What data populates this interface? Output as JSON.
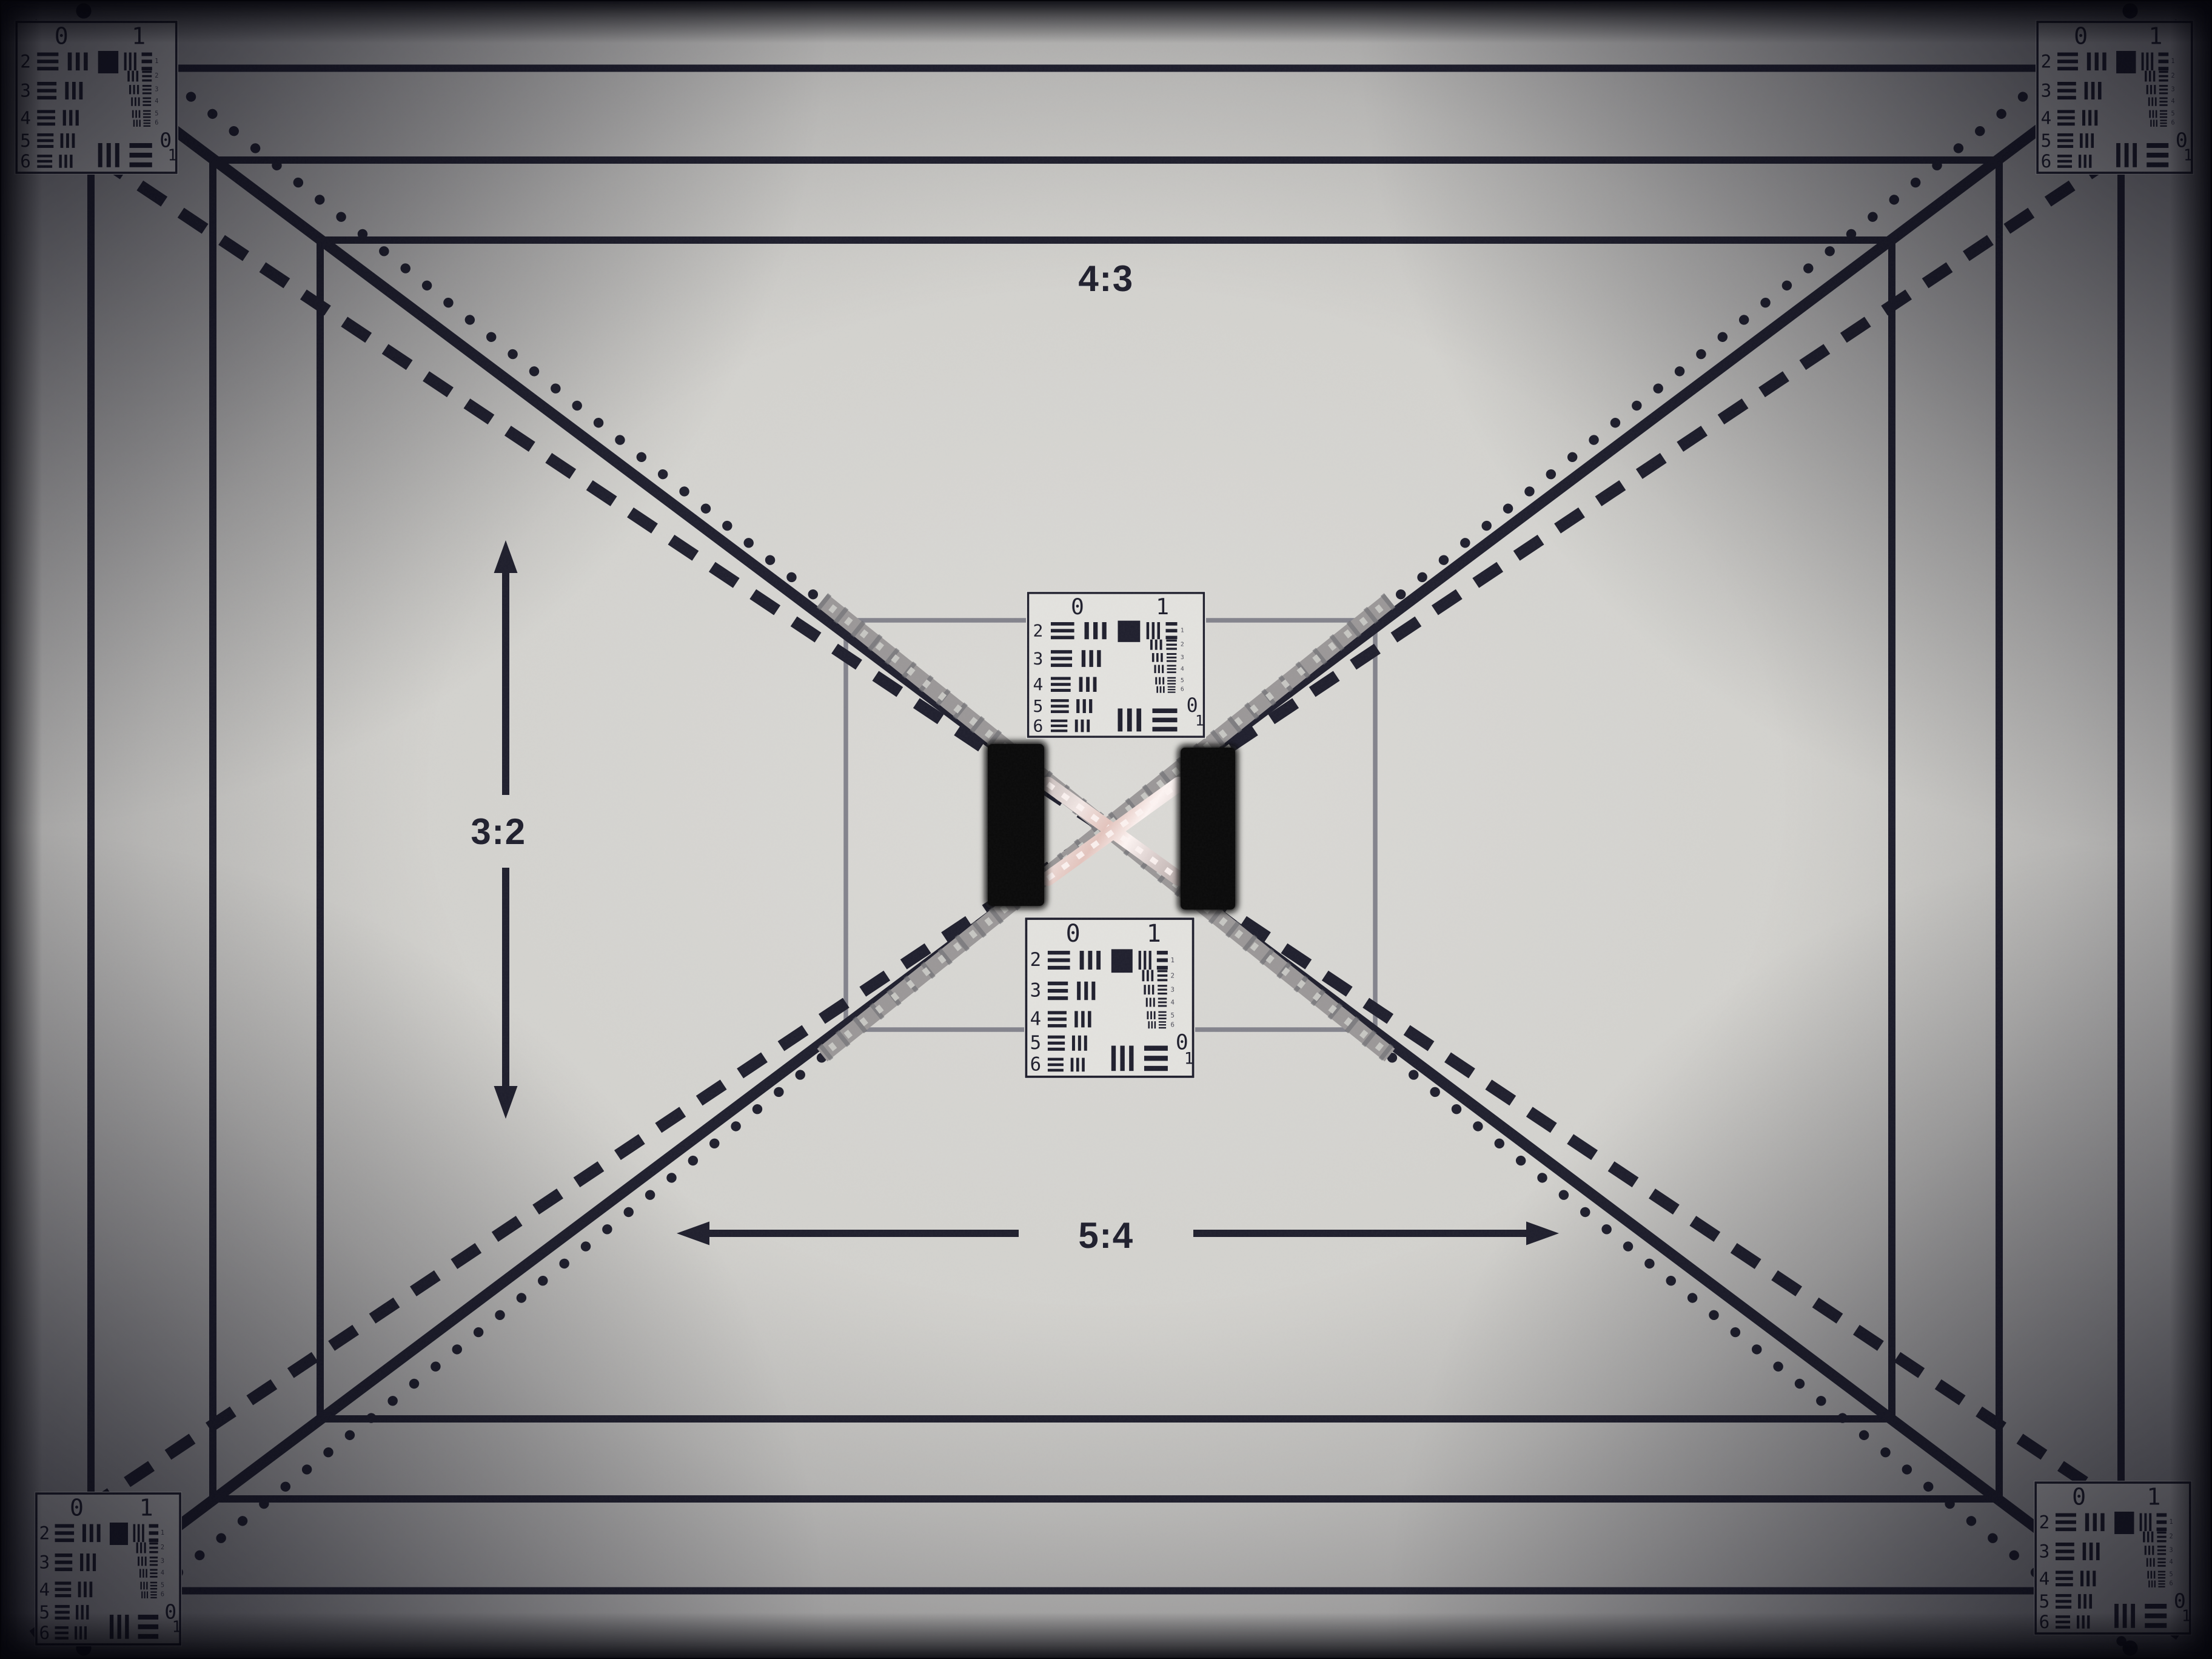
{
  "scene": {
    "description": "Photograph of a printed camera lens test chart with aspect-ratio frames, diagonal reference lines, six USAF-1951 resolution targets, two black velcro pads and a metallic reflective X at the center"
  },
  "labels": {
    "aspect_top": "4:3",
    "aspect_left": "3:2",
    "aspect_bottom": "5:4"
  },
  "usaf_target": {
    "top_left_label": "0",
    "top_right_label": "1",
    "row_labels": [
      "2",
      "3",
      "4",
      "5",
      "6"
    ],
    "right_element_labels": [
      "1",
      "2",
      "3",
      "4",
      "5",
      "6"
    ],
    "bottom_right_top_label": "0",
    "bottom_right_bottom_label": "1",
    "instances": [
      "top-left",
      "top-right",
      "bottom-left",
      "bottom-right",
      "center-top",
      "center-bottom"
    ]
  },
  "colors": {
    "paper_center": "#dbdad6",
    "paper_edge": "#949497",
    "ink": "#20202e",
    "center_rect_line": "#83838c",
    "target_background": "#e3e2de",
    "velcro": "#0a0a0a",
    "tape_base": "#9b9898",
    "tape_tick_dark": "#6f6f74",
    "tape_tick_light": "#c6c6c2",
    "metal_highlight": "#fdf4f2",
    "metal_base": "#c9bebc",
    "small_element_digits": "#4d4d58"
  }
}
